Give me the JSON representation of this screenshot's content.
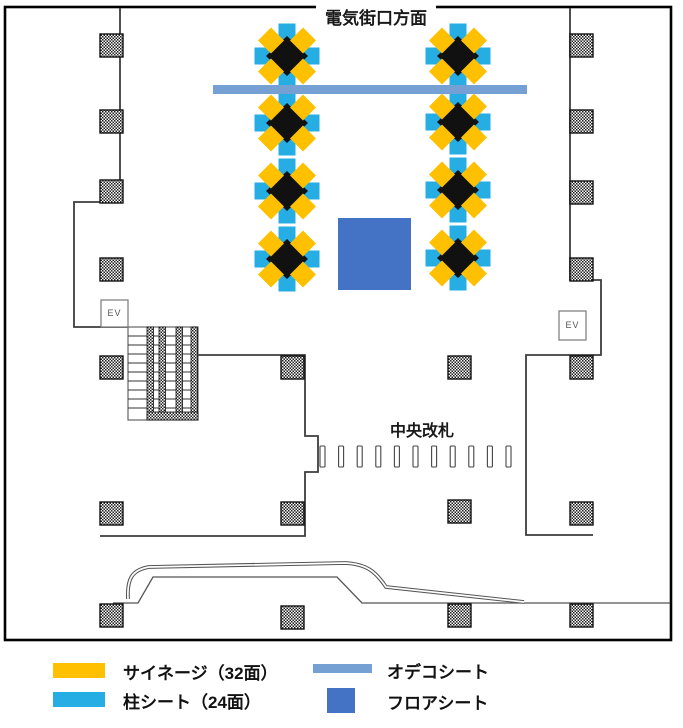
{
  "title": "電気街口方面",
  "plan": {
    "gate_label": "中央改札",
    "elevator_label": "EV",
    "decorated_pillars": [
      {
        "x": 287,
        "y": 56
      },
      {
        "x": 287,
        "y": 123
      },
      {
        "x": 287,
        "y": 191
      },
      {
        "x": 287,
        "y": 259
      },
      {
        "x": 458,
        "y": 56
      },
      {
        "x": 458,
        "y": 122
      },
      {
        "x": 458,
        "y": 190
      },
      {
        "x": 458,
        "y": 258
      }
    ],
    "hatched_pillars": [
      [
        100,
        34
      ],
      [
        100,
        110
      ],
      [
        100,
        180
      ],
      [
        100,
        258
      ],
      [
        100,
        356
      ],
      [
        100,
        502
      ],
      [
        100,
        604
      ],
      [
        570,
        34
      ],
      [
        570,
        110
      ],
      [
        570,
        181
      ],
      [
        570,
        258
      ],
      [
        570,
        356
      ],
      [
        570,
        502
      ],
      [
        570,
        604
      ],
      [
        281,
        356
      ],
      [
        281,
        502
      ],
      [
        281,
        606
      ],
      [
        448,
        356
      ],
      [
        448,
        500
      ],
      [
        448,
        604
      ]
    ],
    "ticket_gates": {
      "count": 11,
      "x_start": 320,
      "x_step": 18.6,
      "y": 446,
      "width": 5,
      "height": 21
    },
    "odeko_sheet_bar": {
      "x": 213,
      "y": 85,
      "w": 314,
      "h": 9
    },
    "floor_sheet_area": {
      "x": 338,
      "y": 218,
      "w": 73,
      "h": 72
    },
    "elevators": [
      {
        "x": 101,
        "y": 300,
        "w": 27,
        "h": 27
      },
      {
        "x": 559,
        "y": 311,
        "w": 27,
        "h": 29
      }
    ]
  },
  "colors": {
    "signage_yellow": "#FFC000",
    "pillar_sheet_cyan": "#25ADE4",
    "odeko_sheet_blue": "#74A0D4",
    "floor_sheet_blue": "#4472C4",
    "pillar_core_black": "#111111",
    "wall": "#3d3d3d"
  },
  "legend": {
    "items": [
      {
        "label": "サイネージ（32面）",
        "color": "#FFC000",
        "swatch": "bar"
      },
      {
        "label": "柱シート（24面）",
        "color": "#25ADE4",
        "swatch": "bar"
      },
      {
        "label": "オデコシート",
        "color": "#74A0D4",
        "swatch": "thin-bar"
      },
      {
        "label": "フロアシート",
        "color": "#4472C4",
        "swatch": "square"
      }
    ]
  }
}
